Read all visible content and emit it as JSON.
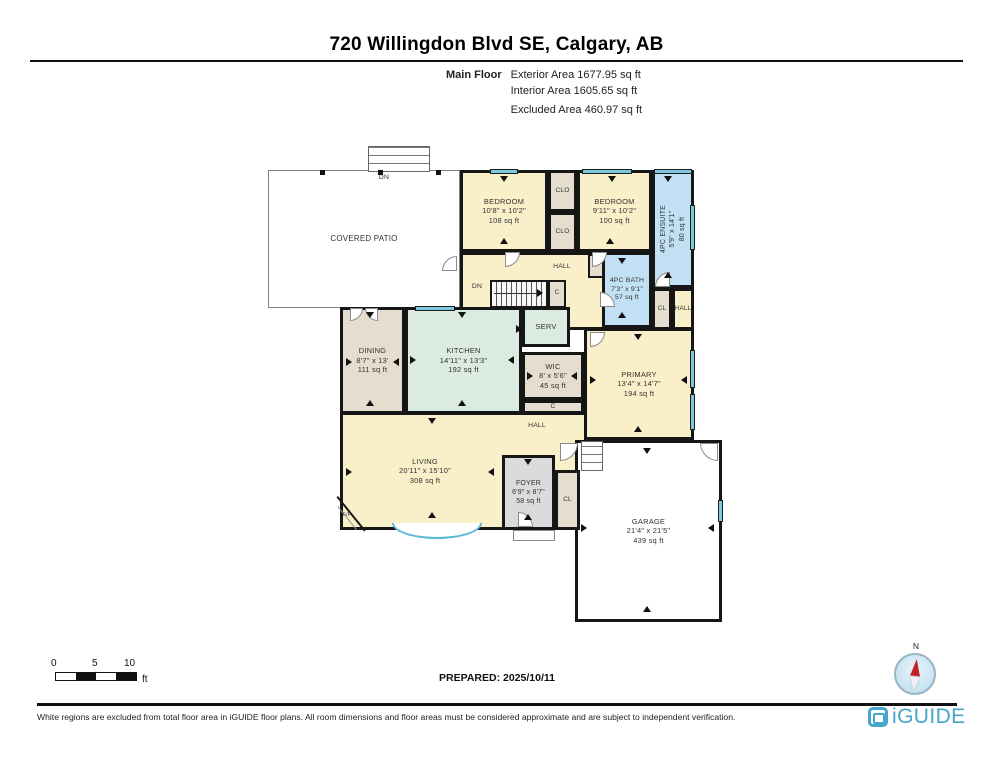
{
  "header": {
    "title": "720 Willingdon Blvd SE, Calgary, AB",
    "floor_label": "Main Floor",
    "areas": {
      "exterior": "Exterior Area 1677.95 sq ft",
      "interior": "Interior Area 1605.65 sq ft",
      "excluded": "Excluded Area 460.97 sq ft"
    }
  },
  "rooms": {
    "covered_patio": {
      "name": "COVERED PATIO"
    },
    "bedroom_left": {
      "name": "BEDROOM",
      "dims": "10'8\" x 10'2\"",
      "area": "108 sq ft"
    },
    "bedroom_right": {
      "name": "BEDROOM",
      "dims": "9'11\" x 10'2\"",
      "area": "100 sq ft"
    },
    "ensuite": {
      "name": "4PC ENSUITE",
      "dims": "5'9\" x 14'1\"",
      "area": "80 sq ft"
    },
    "bath": {
      "name": "4PC BATH",
      "dims": "7'3\" x 9'1\"",
      "area": "57 sq ft"
    },
    "dining": {
      "name": "DINING",
      "dims": "8'7\" x 13'",
      "area": "111 sq ft"
    },
    "kitchen": {
      "name": "KITCHEN",
      "dims": "14'11\" x 13'3\"",
      "area": "192 sq ft"
    },
    "wic": {
      "name": "WIC",
      "dims": "8' x 5'6\"",
      "area": "45 sq ft"
    },
    "primary": {
      "name": "PRIMARY",
      "dims": "13'4\" x 14'7\"",
      "area": "194 sq ft"
    },
    "living": {
      "name": "LIVING",
      "dims": "20'11\" x 15'10\"",
      "area": "308 sq ft"
    },
    "foyer": {
      "name": "FOYER",
      "dims": "6'9\" x 8'7\"",
      "area": "58 sq ft"
    },
    "garage": {
      "name": "GARAGE",
      "dims": "21'4\" x 21'5\"",
      "area": "439 sq ft"
    }
  },
  "tags": {
    "clo": "CLO",
    "hall": "HALL",
    "serv": "SERV",
    "c": "C",
    "cl": "CL",
    "dn": "DN",
    "fp": "F/P"
  },
  "scale_bar": {
    "tick0": "0",
    "tick5": "5",
    "tick10": "10",
    "unit": "ft"
  },
  "prepared": "PREPARED: 2025/10/11",
  "compass": {
    "north": "N"
  },
  "footer": {
    "disclaimer": "White regions are excluded from total floor area in iGUIDE floor plans. All room dimensions and floor areas must be considered approximate and are subject to independent verification.",
    "brand": "iGUIDE"
  },
  "colors": {
    "room_cream": "#F9EFC9",
    "room_tan": "#E5DDCE",
    "room_blue": "#C2E0F3",
    "room_green": "#DBEBE1",
    "room_gray": "#DBDBDB",
    "wall": "#161616",
    "window_glass": "#7CC8DF",
    "brand_blue": "#45A6CE",
    "needle_red": "#C32222"
  }
}
